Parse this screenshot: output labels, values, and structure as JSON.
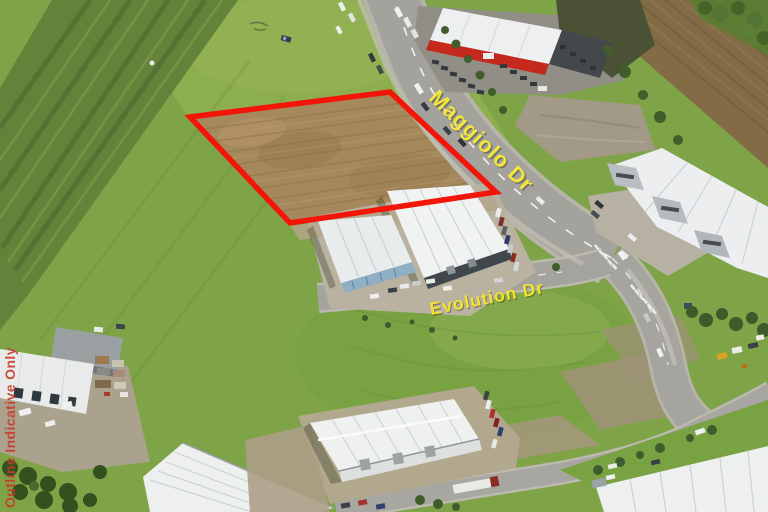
{
  "scene": {
    "road_label_primary": "Maggiolo Dr",
    "road_label_secondary": "Evolution Dr",
    "watermark": "Outline Indicative Only"
  },
  "colors": {
    "site_outline": "#f21508",
    "primary_label": "#f4e73c",
    "secondary_label": "#f4e231",
    "watermark": "#c83b2e"
  }
}
